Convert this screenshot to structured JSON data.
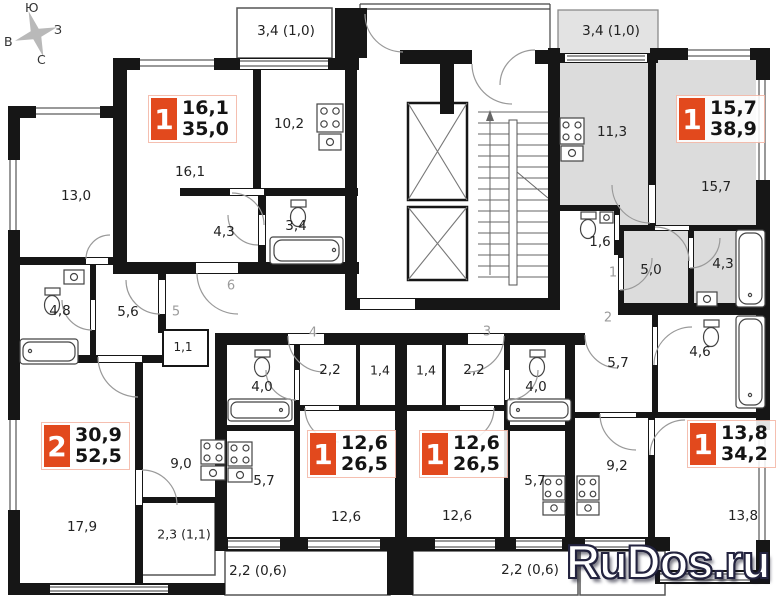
{
  "watermark": "RuDos.ru",
  "compass": {
    "top": "Ю",
    "right": "З",
    "left": "В",
    "bottom": "С"
  },
  "corridor": {
    "n1": "1",
    "n2": "2",
    "n3": "3",
    "n4": "4",
    "n5": "5",
    "n6": "6"
  },
  "apartments": {
    "a": {
      "badge": "1",
      "living": "16,1",
      "total": "35,0",
      "room": "16,1",
      "kitchen": "10,2",
      "hall": "4,3",
      "bath": "3,4",
      "balcony": "3,4 (1,0)"
    },
    "b": {
      "badge": "1",
      "living": "15,7",
      "total": "38,9",
      "room": "15,7",
      "kitchen": "11,3",
      "hall": "5,0",
      "bath": "4,3",
      "wc": "1,6",
      "balcony": "3,4 (1,0)"
    },
    "c": {
      "badge": "2",
      "living": "30,9",
      "total": "52,5",
      "room1": "13,0",
      "room2": "17,9",
      "kitchen": "9,0",
      "hall": "5,6",
      "bath": "4,8",
      "wardrobe": "1,1",
      "balcony": "2,3 (1,1)"
    },
    "d": {
      "badge": "1",
      "living": "12,6",
      "total": "26,5",
      "room": "12,6",
      "kitchen": "5,7",
      "hall": "2,2",
      "bath": "4,0",
      "wardrobe": "1,4",
      "balcony": "2,2 (0,6)"
    },
    "e": {
      "badge": "1",
      "living": "12,6",
      "total": "26,5",
      "room": "12,6",
      "kitchen": "5,7",
      "hall": "2,2",
      "bath": "4,0",
      "wardrobe": "1,4",
      "balcony": "2,2 (0,6)"
    },
    "f": {
      "badge": "1",
      "living": "13,8",
      "total": "34,2",
      "room": "13,8",
      "kitchen": "9,2",
      "hall": "5,7",
      "bath": "4,6"
    }
  },
  "colors": {
    "accent": "#e2491d",
    "highlight": "#dcdcdc",
    "wall": "#161616"
  }
}
